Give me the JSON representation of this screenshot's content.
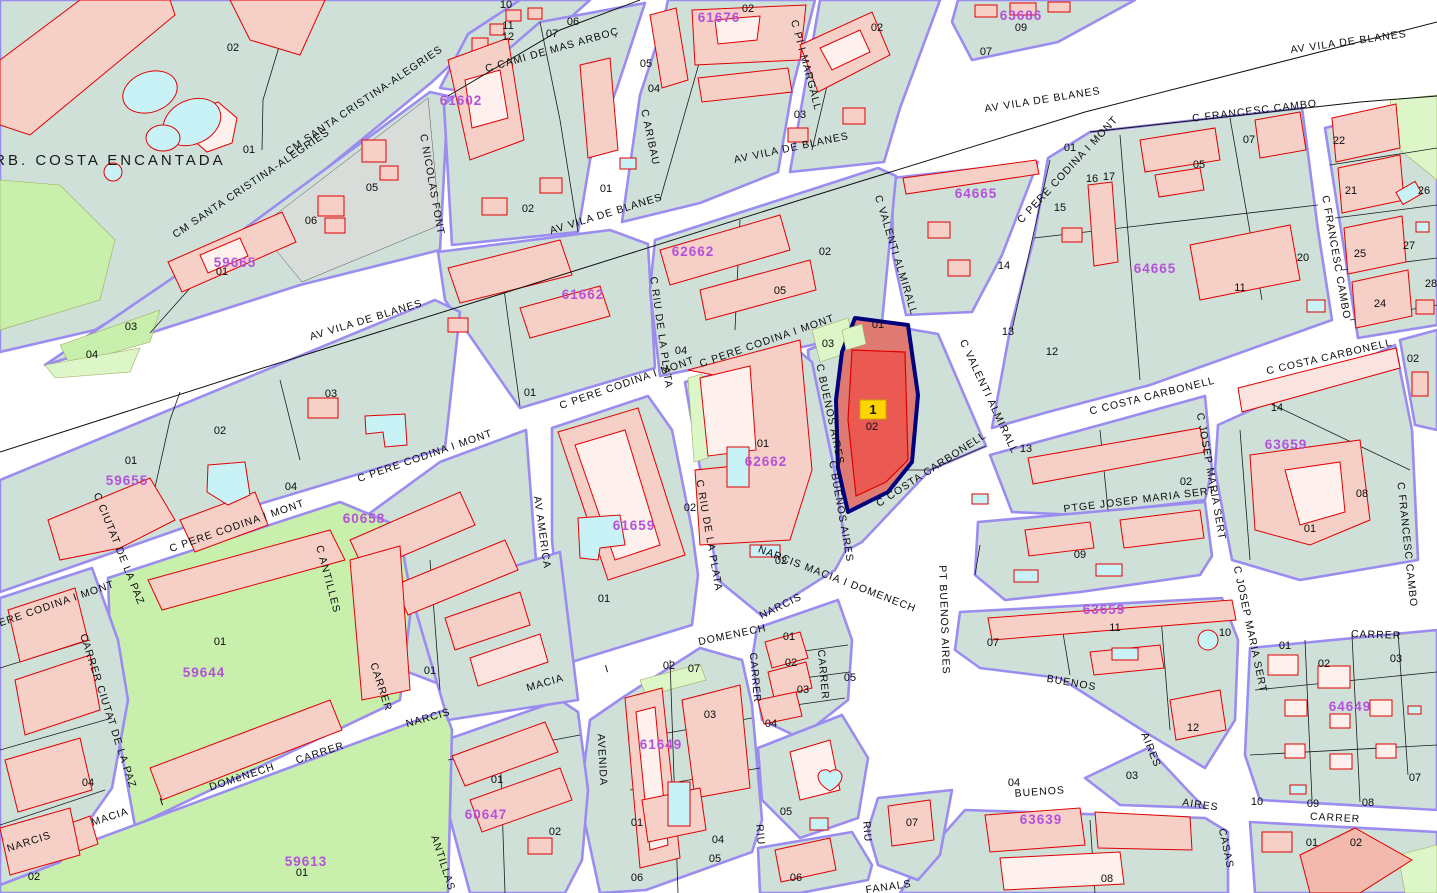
{
  "map": {
    "colors": {
      "road": "#FFFFFF",
      "block": "#CFE0D8",
      "casing": "#9B8CF0",
      "building": "#F6CFC7",
      "building_outline": "#E10000",
      "green": "#C9EFAD",
      "water": "#C9F2F7",
      "accent_code": "#B551D9",
      "highlight_fill": "#DF7A72",
      "highlight_building": "#EA5A52",
      "highlight_border": "#00007D",
      "marker_yellow": "#FFD500"
    },
    "area_label": {
      "t": "URB. COSTA ENCANTADA",
      "x": 103,
      "y": 165,
      "r": 0
    },
    "selected_parcel": {
      "marker": "1",
      "number": "02",
      "code": "62667"
    },
    "street_labels": [
      {
        "t": "CM SANTA CRISTINA-ALEGRIES",
        "x": 253,
        "y": 186,
        "r": -34
      },
      {
        "t": "CM SANTA CRISTINA-ALEGRIES",
        "x": 366,
        "y": 103,
        "r": -34
      },
      {
        "t": "C CAMI DE MAS ARBOÇ",
        "x": 553,
        "y": 53,
        "r": -16
      },
      {
        "t": "C NICOLAS FONT",
        "x": 429,
        "y": 185,
        "r": 80
      },
      {
        "t": "C ARIBAU",
        "x": 647,
        "y": 138,
        "r": 78
      },
      {
        "t": "C PI I MARGALL",
        "x": 803,
        "y": 66,
        "r": 75
      },
      {
        "t": "AV VILA DE BLANES",
        "x": 367,
        "y": 323,
        "r": -17
      },
      {
        "t": "AV VILA DE BLANES",
        "x": 607,
        "y": 217,
        "r": -17
      },
      {
        "t": "AV VILA DE BLANES",
        "x": 792,
        "y": 151,
        "r": -12
      },
      {
        "t": "AV VILA DE BLANES",
        "x": 1043,
        "y": 103,
        "r": -9
      },
      {
        "t": "AV VILA DE BLANES",
        "x": 1349,
        "y": 45,
        "r": -8
      },
      {
        "t": "C FRANCESC CAMBO",
        "x": 1255,
        "y": 114,
        "r": -7
      },
      {
        "t": "C FRANCESC CAMBO",
        "x": 1333,
        "y": 258,
        "r": 80
      },
      {
        "t": "C FRANCESC CAMBO",
        "x": 1404,
        "y": 545,
        "r": 84
      },
      {
        "t": "C PERE CODINA I MONT",
        "x": 1070,
        "y": 172,
        "r": -47
      },
      {
        "t": "C PERE CODINA I MONT",
        "x": 768,
        "y": 344,
        "r": -19
      },
      {
        "t": "C PERE CODINA I MONT",
        "x": 628,
        "y": 386,
        "r": -19
      },
      {
        "t": "C PERE CODINA I MONT",
        "x": 426,
        "y": 459,
        "r": -19
      },
      {
        "t": "C PERE CODINA I MONT",
        "x": 238,
        "y": 529,
        "r": -19
      },
      {
        "t": "C PERE CODINA I MONT",
        "x": 48,
        "y": 610,
        "r": -19
      },
      {
        "t": "C VALENTI ALMIRALL",
        "x": 893,
        "y": 256,
        "r": 73
      },
      {
        "t": "C VALENTI ALMIRALL",
        "x": 986,
        "y": 398,
        "r": 65
      },
      {
        "t": "C COSTA CARBONELL",
        "x": 1153,
        "y": 399,
        "r": -14
      },
      {
        "t": "C COSTA CARBONELL",
        "x": 1330,
        "y": 360,
        "r": -13
      },
      {
        "t": "C COSTA CARBONELL",
        "x": 933,
        "y": 472,
        "r": -33
      },
      {
        "t": "C BUENOS AIRES",
        "x": 827,
        "y": 415,
        "r": 78
      },
      {
        "t": "C BUENOS AIRES",
        "x": 838,
        "y": 512,
        "r": 80
      },
      {
        "t": "PT BUENOS AIRES",
        "x": 941,
        "y": 620,
        "r": 88
      },
      {
        "t": "C RIU DE LA PLATA",
        "x": 658,
        "y": 333,
        "r": 82
      },
      {
        "t": "C RIU DE LA PLATA",
        "x": 706,
        "y": 536,
        "r": 80
      },
      {
        "t": "AV AMERICA",
        "x": 539,
        "y": 533,
        "r": 82
      },
      {
        "t": "AVENIDA",
        "x": 599,
        "y": 760,
        "r": 87
      },
      {
        "t": "C ANTILLES",
        "x": 325,
        "y": 580,
        "r": 75
      },
      {
        "t": "ANTILLAS",
        "x": 440,
        "y": 864,
        "r": 72
      },
      {
        "t": "C CIUTAT DE LA PAZ",
        "x": 116,
        "y": 550,
        "r": 68
      },
      {
        "t": "CARRER CIUTAT DE LA PAZ",
        "x": 105,
        "y": 712,
        "r": 72
      },
      {
        "t": "NARCIS",
        "x": 30,
        "y": 845,
        "r": -18
      },
      {
        "t": "MACIA",
        "x": 111,
        "y": 820,
        "r": -18
      },
      {
        "t": "I",
        "x": 163,
        "y": 805,
        "r": -18
      },
      {
        "t": "DOMèNECH",
        "x": 243,
        "y": 780,
        "r": -18
      },
      {
        "t": "CARRER",
        "x": 321,
        "y": 756,
        "r": -18
      },
      {
        "t": "CARRER",
        "x": 378,
        "y": 688,
        "r": 72
      },
      {
        "t": "NARCIS",
        "x": 429,
        "y": 721,
        "r": -16
      },
      {
        "t": "MACIA",
        "x": 546,
        "y": 686,
        "r": -16
      },
      {
        "t": "I",
        "x": 608,
        "y": 672,
        "r": -16
      },
      {
        "t": "DOMENECH",
        "x": 733,
        "y": 638,
        "r": -12
      },
      {
        "t": "NARCIS",
        "x": 782,
        "y": 609,
        "r": -26
      },
      {
        "t": "NARCIS MACIA I DOMENECH",
        "x": 836,
        "y": 582,
        "r": 21
      },
      {
        "t": "PTGE JOSEP MARIA SERT",
        "x": 1140,
        "y": 503,
        "r": -7
      },
      {
        "t": "C JOSEP MARIA SERT",
        "x": 1208,
        "y": 477,
        "r": 80
      },
      {
        "t": "C JOSEP MARIA SERT",
        "x": 1247,
        "y": 630,
        "r": 78
      },
      {
        "t": "CARRER",
        "x": 1376,
        "y": 638,
        "r": 2
      },
      {
        "t": "BUENOS",
        "x": 1071,
        "y": 686,
        "r": 10
      },
      {
        "t": "AIRES",
        "x": 1148,
        "y": 751,
        "r": 68
      },
      {
        "t": "BUENOS",
        "x": 1040,
        "y": 795,
        "r": -4
      },
      {
        "t": "AIRES",
        "x": 1200,
        "y": 808,
        "r": 8
      },
      {
        "t": "CARRER",
        "x": 1335,
        "y": 821,
        "r": 3
      },
      {
        "t": "CASAS",
        "x": 1223,
        "y": 849,
        "r": 78
      },
      {
        "t": "FANALS",
        "x": 889,
        "y": 890,
        "r": -8
      },
      {
        "t": "CARRER",
        "x": 752,
        "y": 678,
        "r": 85
      },
      {
        "t": "CARRER",
        "x": 820,
        "y": 675,
        "r": 85
      },
      {
        "t": "RIU",
        "x": 757,
        "y": 835,
        "r": 85
      },
      {
        "t": "RIU",
        "x": 864,
        "y": 832,
        "r": 85
      }
    ],
    "block_codes": [
      {
        "t": "59665",
        "x": 235,
        "y": 267
      },
      {
        "t": "61602",
        "x": 461,
        "y": 105
      },
      {
        "t": "61676",
        "x": 719,
        "y": 22
      },
      {
        "t": "63686",
        "x": 1021,
        "y": 20
      },
      {
        "t": "64665",
        "x": 976,
        "y": 198
      },
      {
        "t": "64665",
        "x": 1155,
        "y": 273
      },
      {
        "t": "61662",
        "x": 583,
        "y": 299
      },
      {
        "t": "62662",
        "x": 693,
        "y": 256
      },
      {
        "t": "62662",
        "x": 766,
        "y": 466
      },
      {
        "t": "59655",
        "x": 127,
        "y": 485
      },
      {
        "t": "60658",
        "x": 364,
        "y": 523
      },
      {
        "t": "61659",
        "x": 634,
        "y": 530
      },
      {
        "t": "61649",
        "x": 661,
        "y": 749
      },
      {
        "t": "60647",
        "x": 486,
        "y": 819
      },
      {
        "t": "59644",
        "x": 204,
        "y": 677
      },
      {
        "t": "59613",
        "x": 306,
        "y": 866
      },
      {
        "t": "63659",
        "x": 1286,
        "y": 449
      },
      {
        "t": "63659",
        "x": 1104,
        "y": 614
      },
      {
        "t": "63639",
        "x": 1041,
        "y": 824
      },
      {
        "t": "64649",
        "x": 1350,
        "y": 711
      }
    ],
    "parcel_numbers": [
      {
        "t": "02",
        "x": 233,
        "y": 51
      },
      {
        "t": "01",
        "x": 249,
        "y": 153
      },
      {
        "t": "05",
        "x": 372,
        "y": 191
      },
      {
        "t": "06",
        "x": 311,
        "y": 224
      },
      {
        "t": "01",
        "x": 222,
        "y": 275
      },
      {
        "t": "03",
        "x": 131,
        "y": 330
      },
      {
        "t": "04",
        "x": 92,
        "y": 358
      },
      {
        "t": "10",
        "x": 506,
        "y": 8
      },
      {
        "t": "11",
        "x": 508,
        "y": 29
      },
      {
        "t": "12",
        "x": 508,
        "y": 40
      },
      {
        "t": "06",
        "x": 573,
        "y": 25
      },
      {
        "t": "07",
        "x": 552,
        "y": 37
      },
      {
        "t": "02",
        "x": 528,
        "y": 212
      },
      {
        "t": "01",
        "x": 606,
        "y": 192
      },
      {
        "t": "05",
        "x": 646,
        "y": 67
      },
      {
        "t": "04",
        "x": 654,
        "y": 92
      },
      {
        "t": "02",
        "x": 748,
        "y": 12
      },
      {
        "t": "03",
        "x": 800,
        "y": 118
      },
      {
        "t": "02",
        "x": 877,
        "y": 31
      },
      {
        "t": "09",
        "x": 1021,
        "y": 31
      },
      {
        "t": "07",
        "x": 986,
        "y": 55
      },
      {
        "t": "01",
        "x": 1070,
        "y": 151
      },
      {
        "t": "16",
        "x": 1092,
        "y": 182
      },
      {
        "t": "17",
        "x": 1109,
        "y": 180
      },
      {
        "t": "15",
        "x": 1060,
        "y": 211
      },
      {
        "t": "14",
        "x": 1004,
        "y": 269
      },
      {
        "t": "05",
        "x": 1199,
        "y": 168
      },
      {
        "t": "07",
        "x": 1249,
        "y": 143
      },
      {
        "t": "20",
        "x": 1303,
        "y": 261
      },
      {
        "t": "11",
        "x": 1240,
        "y": 291
      },
      {
        "t": "13",
        "x": 1008,
        "y": 335
      },
      {
        "t": "12",
        "x": 1052,
        "y": 355
      },
      {
        "t": "22",
        "x": 1339,
        "y": 144
      },
      {
        "t": "21",
        "x": 1351,
        "y": 194
      },
      {
        "t": "26",
        "x": 1424,
        "y": 194
      },
      {
        "t": "25",
        "x": 1360,
        "y": 257
      },
      {
        "t": "27",
        "x": 1409,
        "y": 249
      },
      {
        "t": "24",
        "x": 1380,
        "y": 307
      },
      {
        "t": "28",
        "x": 1431,
        "y": 287
      },
      {
        "t": "02",
        "x": 1413,
        "y": 362
      },
      {
        "t": "02",
        "x": 220,
        "y": 434
      },
      {
        "t": "01",
        "x": 131,
        "y": 464
      },
      {
        "t": "03",
        "x": 331,
        "y": 397
      },
      {
        "t": "04",
        "x": 291,
        "y": 490
      },
      {
        "t": "01",
        "x": 530,
        "y": 396
      },
      {
        "t": "04",
        "x": 681,
        "y": 354
      },
      {
        "t": "03",
        "x": 828,
        "y": 347
      },
      {
        "t": "02",
        "x": 825,
        "y": 255
      },
      {
        "t": "05",
        "x": 780,
        "y": 294
      },
      {
        "t": "01",
        "x": 878,
        "y": 328
      },
      {
        "t": "01",
        "x": 763,
        "y": 447
      },
      {
        "t": "02",
        "x": 781,
        "y": 564
      },
      {
        "t": "02",
        "x": 690,
        "y": 511
      },
      {
        "t": "01",
        "x": 604,
        "y": 602
      },
      {
        "t": "13",
        "x": 1026,
        "y": 452
      },
      {
        "t": "02",
        "x": 1186,
        "y": 485
      },
      {
        "t": "09",
        "x": 1080,
        "y": 558
      },
      {
        "t": "14",
        "x": 1277,
        "y": 411
      },
      {
        "t": "08",
        "x": 1362,
        "y": 497
      },
      {
        "t": "01",
        "x": 1310,
        "y": 532
      },
      {
        "t": "01",
        "x": 220,
        "y": 645
      },
      {
        "t": "01",
        "x": 430,
        "y": 674
      },
      {
        "t": "04",
        "x": 88,
        "y": 786
      },
      {
        "t": "02",
        "x": 34,
        "y": 880
      },
      {
        "t": "01",
        "x": 302,
        "y": 876
      },
      {
        "t": "01",
        "x": 497,
        "y": 783
      },
      {
        "t": "02",
        "x": 555,
        "y": 835
      },
      {
        "t": "02",
        "x": 669,
        "y": 669
      },
      {
        "t": "07",
        "x": 694,
        "y": 672
      },
      {
        "t": "03",
        "x": 710,
        "y": 718
      },
      {
        "t": "01",
        "x": 637,
        "y": 826
      },
      {
        "t": "04",
        "x": 718,
        "y": 843
      },
      {
        "t": "05",
        "x": 715,
        "y": 862
      },
      {
        "t": "06",
        "x": 637,
        "y": 881
      },
      {
        "t": "01",
        "x": 789,
        "y": 640
      },
      {
        "t": "02",
        "x": 791,
        "y": 666
      },
      {
        "t": "03",
        "x": 803,
        "y": 693
      },
      {
        "t": "04",
        "x": 771,
        "y": 727
      },
      {
        "t": "05",
        "x": 786,
        "y": 815
      },
      {
        "t": "06",
        "x": 796,
        "y": 881
      },
      {
        "t": "05",
        "x": 850,
        "y": 681
      },
      {
        "t": "07",
        "x": 912,
        "y": 826
      },
      {
        "t": "07",
        "x": 993,
        "y": 646
      },
      {
        "t": "11",
        "x": 1115,
        "y": 631
      },
      {
        "t": "10",
        "x": 1225,
        "y": 636
      },
      {
        "t": "12",
        "x": 1193,
        "y": 731
      },
      {
        "t": "03",
        "x": 1132,
        "y": 779
      },
      {
        "t": "04",
        "x": 1014,
        "y": 786
      },
      {
        "t": "01",
        "x": 1285,
        "y": 649
      },
      {
        "t": "02",
        "x": 1324,
        "y": 667
      },
      {
        "t": "03",
        "x": 1396,
        "y": 662
      },
      {
        "t": "10",
        "x": 1257,
        "y": 805
      },
      {
        "t": "09",
        "x": 1313,
        "y": 807
      },
      {
        "t": "08",
        "x": 1368,
        "y": 806
      },
      {
        "t": "07",
        "x": 1415,
        "y": 781
      },
      {
        "t": "08",
        "x": 1107,
        "y": 882
      },
      {
        "t": "01",
        "x": 1312,
        "y": 846
      },
      {
        "t": "02",
        "x": 1356,
        "y": 846
      }
    ]
  }
}
